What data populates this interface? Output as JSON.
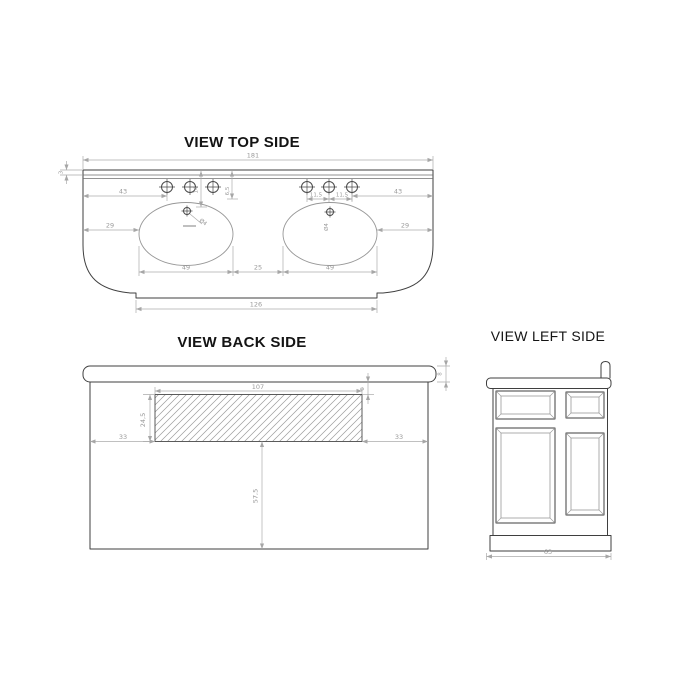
{
  "canvas": {
    "background": "#ffffff",
    "outline_color": "#3f3f3f",
    "dimension_color": "#9a9a9a",
    "title_color": "#141414"
  },
  "views": {
    "top": {
      "title": "VIEW TOP SIDE",
      "dims": {
        "overall_width": "181",
        "backsplash_depth": "3",
        "left_to_faucets": "43",
        "faucets_to_right": "43",
        "faucet_spacing_a": "11,5",
        "faucet_spacing_b": "11,5",
        "faucets_from_back": "6,5",
        "drain_from_back": "14",
        "left_to_basin": "29",
        "basin_to_right": "29",
        "basin_width_left": "49",
        "between_basins": "25",
        "basin_width_right": "49",
        "front_width": "126",
        "drain_dia_left": "Ø4",
        "drain_dia_right": "Ø4"
      }
    },
    "back": {
      "title": "VIEW BACK SIDE",
      "dims": {
        "opening_width": "107",
        "opening_height": "24,5",
        "opening_top_gap": "6",
        "top_thickness": "8",
        "opening_left_gap": "33",
        "opening_right_gap": "33",
        "lower_height": "57,5"
      }
    },
    "left": {
      "title": "VIEW LEFT SIDE",
      "dims": {
        "depth": "63"
      }
    }
  }
}
